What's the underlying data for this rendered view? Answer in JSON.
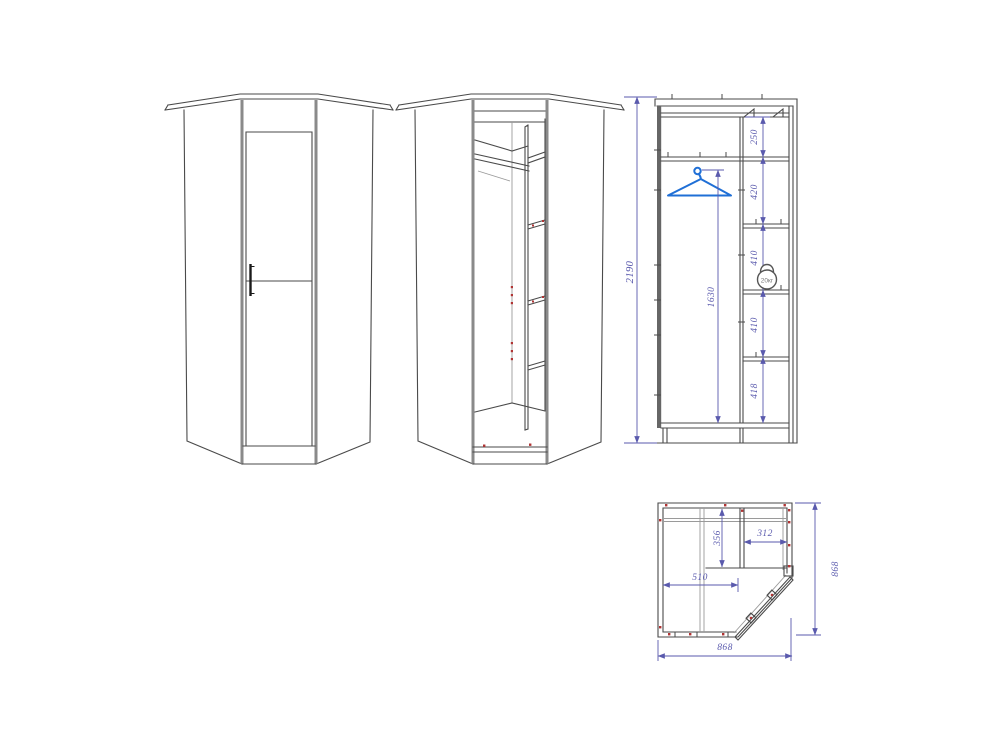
{
  "colors": {
    "background": "#ffffff",
    "line": "#4a4a4a",
    "line_light": "#9a9a9a",
    "panel_edge": "#8a8a8a",
    "dimension": "#5a5aad",
    "hanger_accent": "#1f6fd6",
    "fastener_mark": "#b03434",
    "handle": "#1a1a1a"
  },
  "icons": {
    "hanger": "clothes-hanger-icon",
    "kettlebell": "kettlebell-20kg-icon",
    "fasteners": "fastener-marks"
  },
  "section_view": {
    "total_height": "2190",
    "rod_height": "1630",
    "top_gap": "250",
    "hanging_gap": "420",
    "shelf_gap_upper": "410",
    "shelf_gap_lower": "410",
    "bottom_gap": "418",
    "load_badge": "20кг"
  },
  "plan_view": {
    "outer_width": "868",
    "outer_depth": "868",
    "left_inner_width": "510",
    "shelf_depth": "356",
    "shelf_inner_width": "312"
  }
}
